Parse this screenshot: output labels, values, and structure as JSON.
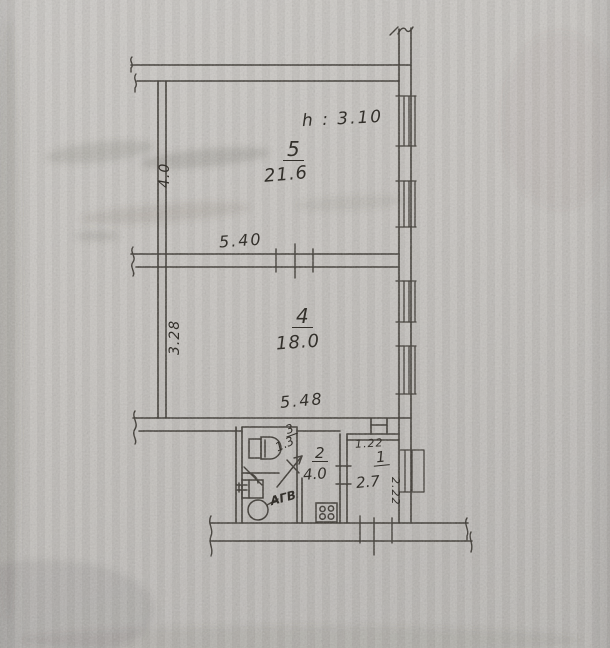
{
  "plan": {
    "height_note": "h : 3.10",
    "rooms": [
      {
        "number": "5",
        "area": "21.6"
      },
      {
        "number": "4",
        "area": "18.0"
      },
      {
        "number": "3",
        "area": "1.3"
      },
      {
        "number": "2",
        "area": "4.0"
      },
      {
        "number": "1",
        "area": "2.7"
      }
    ],
    "dimensions": {
      "room5_side": "4.0",
      "room5_width": "5.40",
      "room4_side": "3.28",
      "room4_width": "5.48",
      "room1_width": "1.22",
      "room1_depth": "2.22"
    },
    "labels": {
      "water_heater": "АГВ"
    },
    "colors": {
      "paper": "#c6c3bf",
      "ink": "#33302b"
    }
  }
}
